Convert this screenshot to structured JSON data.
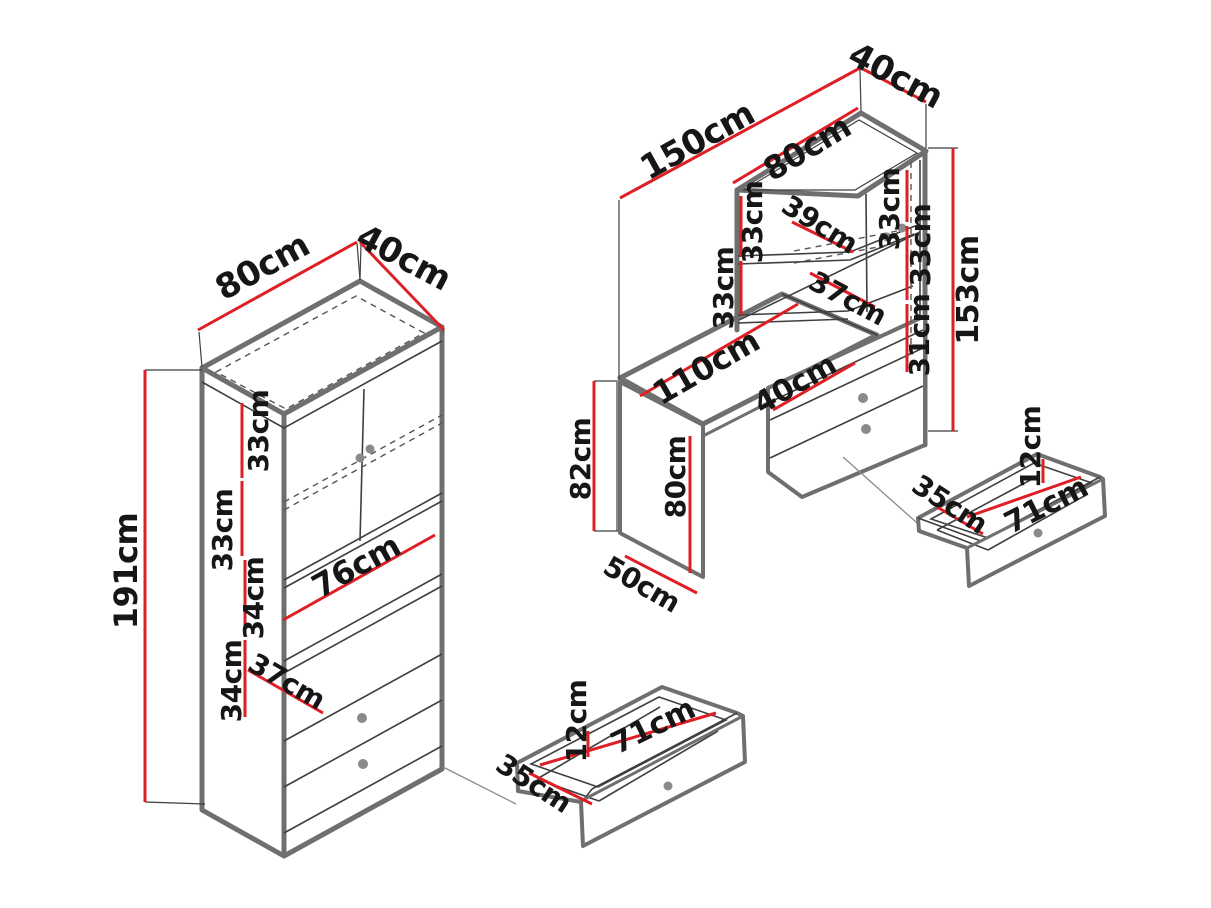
{
  "diagram": {
    "type": "furniture-dimension-drawing",
    "unit": "cm",
    "background": "#ffffff",
    "colors": {
      "dimension_line": "#de1f26",
      "outline": "#6f6f6f",
      "detail_line": "#3f3f3f",
      "knob": "#8a8a8a",
      "text": "#161616"
    }
  },
  "cabinet": {
    "width": "80cm",
    "depth": "40cm",
    "height": "191cm",
    "shelf_sections": [
      "33cm",
      "33cm",
      "34cm",
      "34cm"
    ],
    "inner_width": "76cm",
    "inner_depth": "37cm"
  },
  "cabinet_drawer": {
    "front_height": "12cm",
    "length": "71cm",
    "depth": "35cm"
  },
  "desk": {
    "total_width": "150cm",
    "top_unit_depth": "40cm",
    "hutch_width": "80cm",
    "hutch_left_sections": [
      "33cm",
      "33cm"
    ],
    "hutch_shelf_depth_upper": "39cm",
    "hutch_shelf_depth_lower": "37cm",
    "hutch_door_section": "33cm",
    "hutch_right_sections": [
      "33cm",
      "31cm"
    ],
    "total_height": "153cm",
    "desktop_length": "110cm",
    "pedestal_niche_width": "40cm",
    "side_panel_height": "82cm",
    "inner_leg_height": "80cm",
    "side_panel_depth": "50cm"
  },
  "desk_drawer": {
    "front_height": "12cm",
    "depth": "35cm",
    "length": "71cm"
  }
}
